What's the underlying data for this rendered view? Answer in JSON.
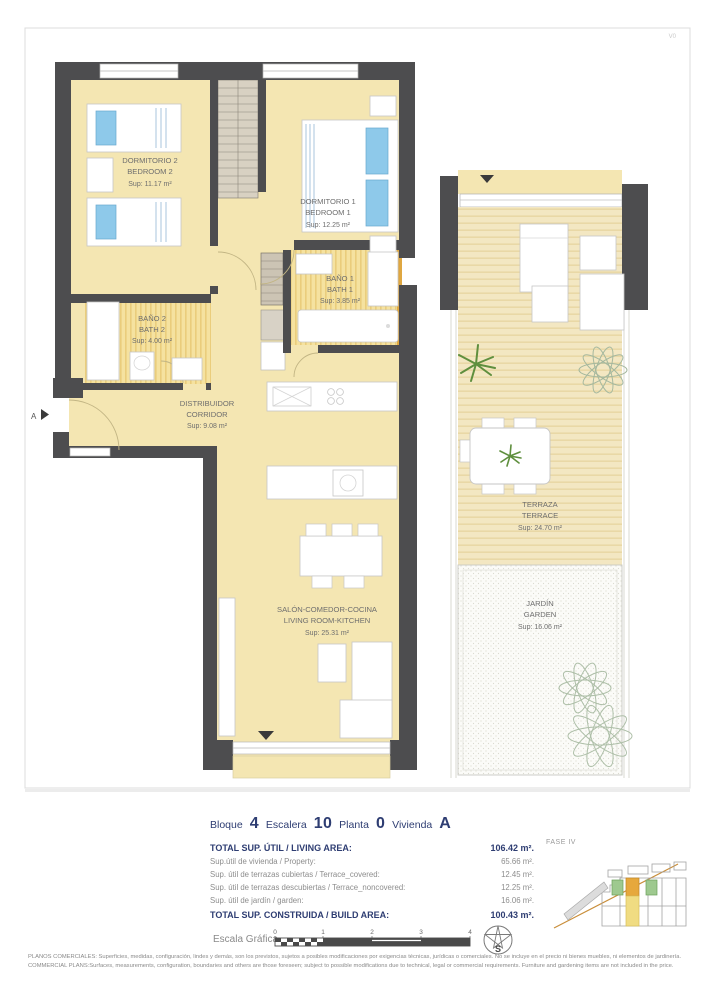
{
  "page": {
    "code": "V0"
  },
  "plan": {
    "marker_a": "A",
    "rooms": {
      "bedroom2": {
        "es": "DORMITORIO 2",
        "en": "BEDROOM 2",
        "area": "Sup: 11.17 m²"
      },
      "bedroom1": {
        "es": "DORMITORIO 1",
        "en": "BEDROOM 1",
        "area": "Sup: 12.25 m²"
      },
      "bath1": {
        "es": "BAÑO 1",
        "en": "BATH 1",
        "area": "Sup: 3.85 m²"
      },
      "bath2": {
        "es": "BAÑO 2",
        "en": "BATH 2",
        "area": "Sup: 4.00 m²"
      },
      "corridor": {
        "es": "DISTRIBUIDOR",
        "en": "CORRIDOR",
        "area": "Sup: 9.08 m²"
      },
      "living": {
        "es": "SALÓN-COMEDOR-COCINA",
        "en": "LIVING ROOM-KITCHEN",
        "area": "Sup: 25.31 m²"
      },
      "terrace": {
        "es": "TERRAZA",
        "en": "TERRACE",
        "area": "Sup: 24.70 m²"
      },
      "garden": {
        "es": "JARDÍN",
        "en": "GARDEN",
        "area": "Sup: 16.06 m²"
      }
    }
  },
  "unit": {
    "bloque_label": "Bloque",
    "bloque": "4",
    "escalera_label": "Escalera",
    "escalera": "10",
    "planta_label": "Planta",
    "planta": "0",
    "vivienda_label": "Vivienda",
    "vivienda": "A"
  },
  "areas": {
    "rows": [
      {
        "label": "TOTAL SUP. ÚTIL / LIVING AREA:",
        "value": "106.42 m²."
      },
      {
        "label": "Sup.útil de vivienda / Property:",
        "value": "65.66 m²."
      },
      {
        "label": "Sup. útil de terrazas cubiertas  / Terrace_covered:",
        "value": "12.45 m²."
      },
      {
        "label": "Sup. útil de terrazas descubiertas  / Terrace_noncovered:",
        "value": "12.25 m²."
      },
      {
        "label": "Sup. útil de jardín  / garden:",
        "value": "16.06 m²."
      },
      {
        "label": "TOTAL SUP. CONSTRUIDA / BUILD AREA:",
        "value": "100.43 m²."
      }
    ]
  },
  "site": {
    "phase": "FASE IV"
  },
  "scale": {
    "label": "Escala Gráfica",
    "ticks": [
      "0",
      "1",
      "2",
      "3",
      "4"
    ],
    "compass": "S"
  },
  "disclaimer": {
    "line1": "PLANOS COMERCIALES: Superficies, medidas, configuración, lindes y demás, son los previstos, sujetos a posibles modificaciones por exigencias técnicas, jurídicas o comerciales. No se incluye en el precio ni bienes muebles, ni elementos de jardinería.",
    "line2": "COMMERCIAL PLANS:Surfaces, measurements, configuration, boundaries and others are those foreseen; subject to possible modifications due to technical, legal or commercial requirements. Furniture and gardening items are not included in the price."
  }
}
